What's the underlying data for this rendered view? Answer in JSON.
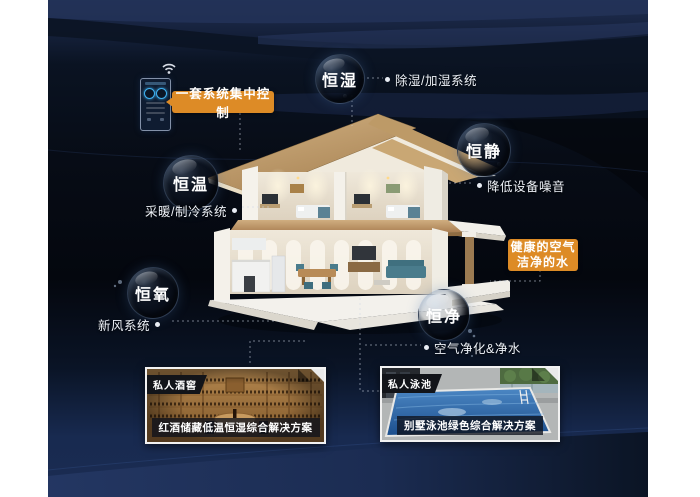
{
  "control_badge": {
    "label": "一套系统集中控制"
  },
  "air_water_badge": {
    "line1": "健康的空气",
    "line2": "洁净的水"
  },
  "bubbles": [
    {
      "label": "恒湿",
      "note": "除湿/加湿系统"
    },
    {
      "label": "恒静",
      "note": "降低设备噪音"
    },
    {
      "label": "恒温",
      "note": "采暖/制冷系统"
    },
    {
      "label": "恒氧",
      "note": "新风系统"
    },
    {
      "label": "恒净",
      "note": "空气净化&净水"
    }
  ],
  "cards": [
    {
      "tag": "私人酒窖",
      "caption": "红酒储藏低温恒湿综合解决方案"
    },
    {
      "tag": "私人泳池",
      "caption": "别墅泳池绿色综合解决方案"
    }
  ],
  "icons": {
    "wifi": "wifi-icon",
    "panel": "smart-control-panel"
  },
  "colors": {
    "accent_orange": "#dd8b26",
    "background_navy": "#1f2e52",
    "background_dark": "#05080f",
    "label_text": "#eef2f8",
    "roof_tan": "#c9a774",
    "pool_blue": "#2d6cae"
  }
}
